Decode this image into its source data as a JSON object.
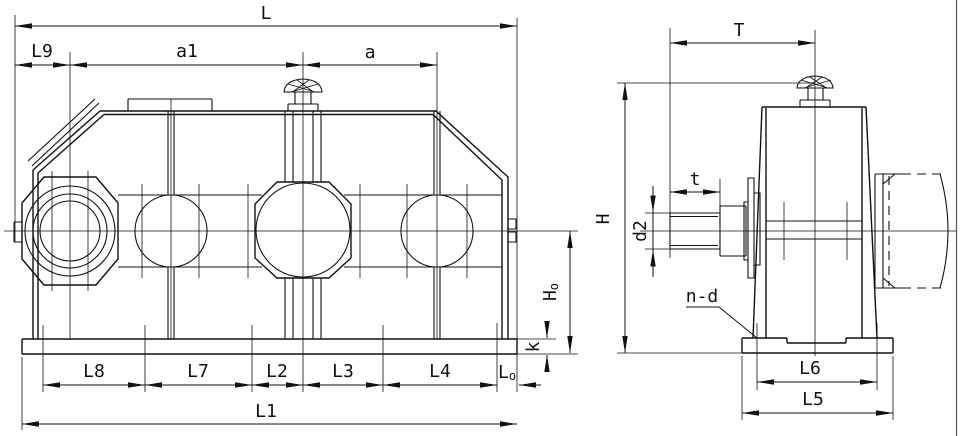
{
  "colors": {
    "line": "#111111",
    "background": "#ffffff"
  },
  "left_view": {
    "dim_labels": {
      "L": "L",
      "L9": "L9",
      "a1": "a1",
      "a": "a",
      "L8": "L8",
      "L7": "L7",
      "L2": "L2",
      "L3": "L3",
      "L4": "L4",
      "L1": "L1",
      "L0": {
        "main": "L",
        "sub": "o"
      },
      "H0": {
        "main": "H",
        "sub": "o"
      },
      "k": "k"
    }
  },
  "right_view": {
    "dim_labels": {
      "T": "T",
      "t": "t",
      "H": "H",
      "d2": "d2",
      "n_d": "n-d",
      "L6": "L6",
      "L5": "L5"
    }
  }
}
